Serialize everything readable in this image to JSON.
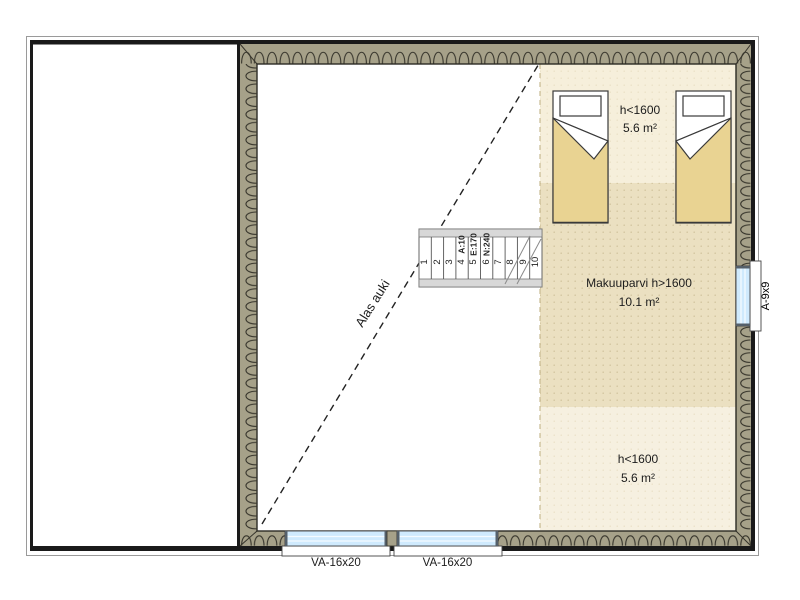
{
  "drawing": {
    "type": "floor-plan",
    "areas": {
      "upper_low_headroom": {
        "label": "h<1600",
        "area": "5.6 m²"
      },
      "sleeping_loft": {
        "label": "Makuuparvi h>1600",
        "area": "10.1 m²"
      },
      "lower_low_headroom": {
        "label": "h<1600",
        "area": "5.6 m²"
      },
      "opening_below": {
        "label": "Alas auki"
      }
    },
    "stairs": {
      "tread_numbers": [
        "1",
        "2",
        "3",
        "4",
        "5",
        "6",
        "7",
        "8",
        "9",
        "10"
      ],
      "specs": [
        "A:10",
        "E:170",
        "N:240"
      ]
    },
    "windows": {
      "bottom_left_label": "VA-16x20",
      "bottom_right_label": "VA-16x20",
      "right_label": "A-9x9"
    },
    "colors": {
      "wall_fill": "#a6a189",
      "wall_line": "#35332a",
      "floor_light": "#f6efdb",
      "floor_mid": "#ebe0c1",
      "floor_lower": "#f6f0e0",
      "blanket": "#e9d392",
      "glazing": "#cfeafd"
    }
  }
}
